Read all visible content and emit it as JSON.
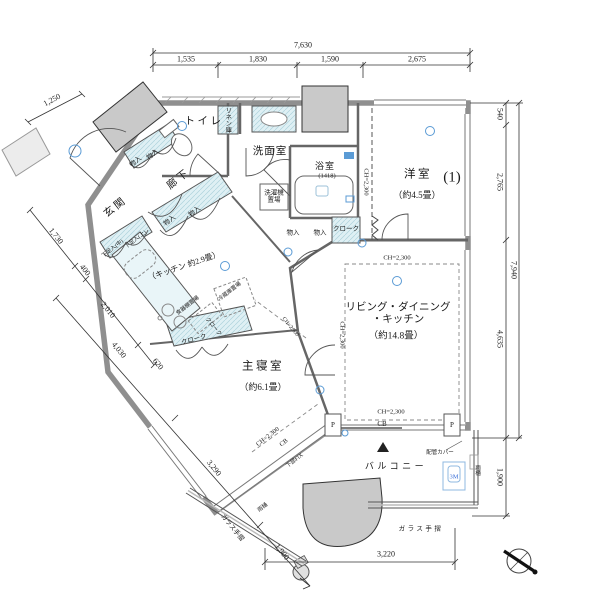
{
  "drawing": {
    "type": "apartment-floor-plan",
    "colors": {
      "wall": "#8f8f8f",
      "closet_fill": "#dff0f4",
      "pillar": "#c9c9c9",
      "symbol_blue": "#5b9bd5",
      "accent_blue": "#3a6fd8"
    }
  },
  "rooms": {
    "toilet": "トイレ",
    "linen": "リネン庫",
    "washroom": "洗面室",
    "bath": "浴室",
    "bath_size": "(1418)",
    "western": "洋室",
    "western_num": "(1)",
    "western_size": "（約4.5畳）",
    "entrance": "玄関",
    "corridor": "廊下",
    "kitchen": "（キッチン 約2.9畳）",
    "ldk_line1": "リビング・ダイニング",
    "ldk_line2": "・キッチン",
    "ldk_size": "（約14.8畳）",
    "master": "主寝室",
    "master_size": "（約6.1畳）",
    "balcony": "バルコニー"
  },
  "storage": {
    "storage": "物入",
    "cloak": "クローク",
    "shoe_mid": "下足入(中)",
    "shoe_up": "下足入(上)",
    "washer": "洗濯機置場",
    "dish_shelf": "食器棚置場",
    "fridge": "冷蔵庫置場"
  },
  "annotations": {
    "ceiling_height": "CH=2,300",
    "cb": "CB",
    "post": "P",
    "lower_fix": "下部FIX",
    "pipe_cover": "配管カバー",
    "m3": "3M",
    "gutter": "雨樋",
    "glass_rail": "ガラス手摺"
  },
  "dims": {
    "top_total": "7,630",
    "top_segments": [
      "1,535",
      "1,830",
      "1,590",
      "2,675"
    ],
    "right": [
      "540",
      "2,765",
      "7,940",
      "4,635",
      "1,900"
    ],
    "left": [
      "1,250",
      "1,730",
      "400",
      "2,010",
      "4,030",
      "620",
      "3,290",
      "1,900"
    ],
    "bottom": "3,220"
  }
}
